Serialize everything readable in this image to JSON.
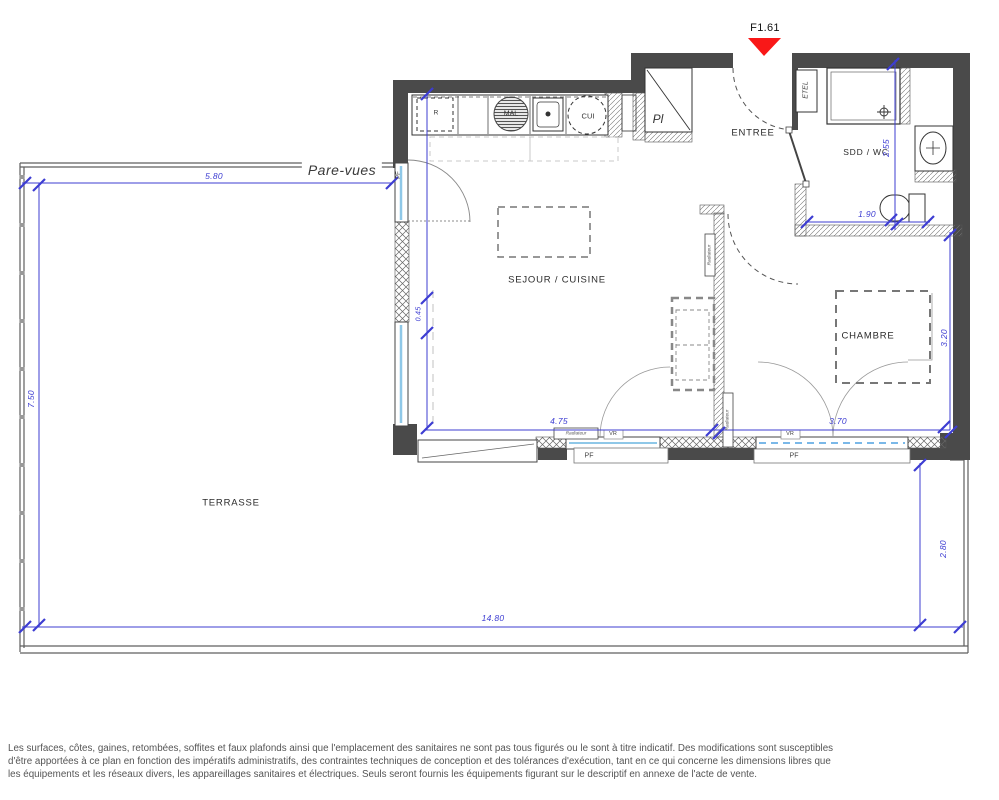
{
  "marker": {
    "label": "F1.61",
    "color": "#f91818"
  },
  "rooms": {
    "sejour_cuisine": "SEJOUR / CUISINE",
    "entree": "ENTREE",
    "sdd_wc": "SDD / WC",
    "chambre": "CHAMBRE",
    "terrasse": "TERRASSE",
    "placard": "Pl"
  },
  "labels": {
    "pare_vues": "Pare-vues",
    "etel": "ETEL",
    "pf": "PF",
    "vr": "VR",
    "radiateur": "Radiateur",
    "fridge": "R",
    "washer": "MAL",
    "cooker": "CUI"
  },
  "dimensions": {
    "terrace_top_width": "5.80",
    "terrace_left_height": "7.50",
    "terrace_bottom_width": "14.80",
    "terrace_right_height": "2.80",
    "sejour_width": "4.75",
    "left_wall_segment": "0.45",
    "chambre_width": "3.70",
    "chambre_height": "3.20",
    "sdd_width": "1.90",
    "sdd_height": "2.55"
  },
  "colors": {
    "wall": "#4a4a4a",
    "dimension_blue": "#3d3dd2",
    "marker_red": "#f91818",
    "glazing_blue": "#8fc8e8"
  },
  "footer": {
    "lines": [
      "Les surfaces, côtes, gaines, retombées, soffites et faux plafonds ainsi que l'emplacement des sanitaires ne sont pas tous figurés ou le sont à titre indicatif. Des modifications sont susceptibles",
      "d'être apportées à ce plan en fonction des impératifs administratifs, des contraintes techniques de conception et des tolérances d'exécution, tant en ce qui concerne les dimensions libres que",
      "les équipements et les réseaux divers, les appareillages sanitaires et électriques. Seuls seront fournis les équipements figurant sur le descriptif en annexe de l'acte de vente."
    ]
  }
}
